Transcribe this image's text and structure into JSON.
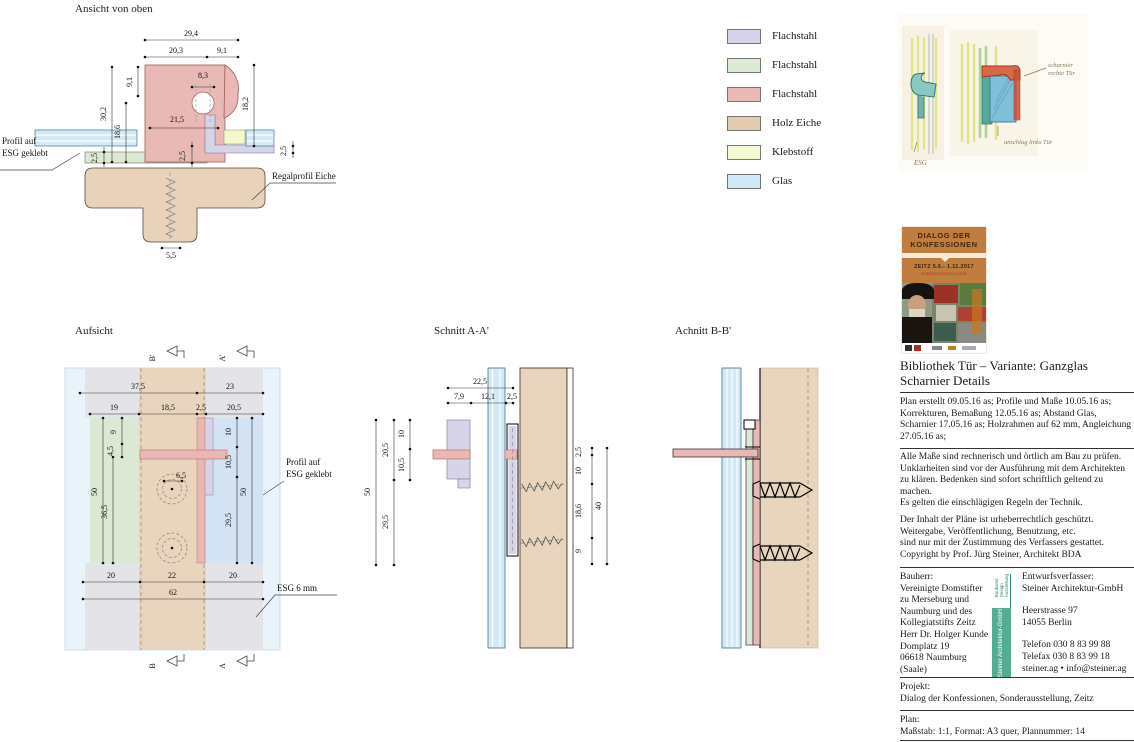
{
  "legend": {
    "items": [
      {
        "label": "Flachstahl",
        "color": "#d6d4e9"
      },
      {
        "label": "Flachstahl",
        "color": "#dcead6"
      },
      {
        "label": "Flachstahl",
        "color": "#e9b9b5"
      },
      {
        "label": "Holz Eiche",
        "color": "#e3c9ae"
      },
      {
        "label": "Klebstoff",
        "color": "#f5f9d2"
      },
      {
        "label": "Glas",
        "color": "#cfe9f7"
      }
    ]
  },
  "views": {
    "ansicht": {
      "title": "Ansicht von oben",
      "dims": {
        "w_total": "29,4",
        "w_left": "20,3",
        "w_right": "9,1",
        "hole": "8,3",
        "right_v": "18,2",
        "left_v1": "30,2",
        "left_v2": "18,6",
        "left_v3": "9,1",
        "mid": "21,5",
        "small_l1": "2,5",
        "small_l2": "2,5",
        "small_r": "2,5",
        "bottom": "5,5"
      },
      "callout_profil_1": "Profil auf",
      "callout_profil_2": "ESG geklebt",
      "callout_regal": "Regalprofil Eiche"
    },
    "aufsicht": {
      "title": "Aufsicht",
      "dims": {
        "t1": "37,5",
        "t2": "23",
        "t3": "19",
        "t4": "18,5",
        "t5": "2,5",
        "t6": "20,5",
        "v_l1": "50",
        "v_l2": "36,5",
        "v_l3": "9",
        "v_l4": "4,5",
        "v_r1": "10",
        "v_r2": "10,5",
        "v_r3": "50",
        "v_r4": "29,5",
        "hole": "6,5",
        "b1": "20",
        "b2": "22",
        "b3": "20",
        "b4": "62"
      },
      "markers": {
        "top_b": "B'",
        "top_a": "A'",
        "bot_b": "B",
        "bot_a": "A"
      },
      "callout_profil_1": "Profil auf",
      "callout_profil_2": "ESG geklebt",
      "callout_esg": "ESG 6 mm"
    },
    "schnitt_a": {
      "title": "Schnitt A-A'",
      "dims": {
        "t1": "22,5",
        "t2": "7,9",
        "t3": "12,1",
        "t4": "2,5",
        "l1": "50",
        "l2": "20,5",
        "l3": "10,5",
        "l4": "10",
        "l5": "29,5",
        "r1": "2,5",
        "r2": "10",
        "r3": "18,6",
        "r4": "9",
        "r5": "40"
      }
    },
    "schnitt_b": {
      "title": "Achnitt B-B'"
    }
  },
  "sketch": {
    "note_hinge_1": "scharnier",
    "note_hinge_2": "rechte Tür",
    "note_stop": "anschlag links Tür",
    "note_esg": "ESG"
  },
  "poster": {
    "line1": "DIALOG DER",
    "line2": "KONFESSIONEN",
    "date": "ZEITZ 5.6.- 1.11.2017",
    "sub": "SONDERAUSSTELLUNG"
  },
  "titleblock": {
    "title_line1": "Bibliothek Tür – Variante: Ganzglas",
    "title_line2": "Scharnier Details",
    "revisions": "Plan erstellt 09.05.16 as; Profile und Maße 10.05.16 as;\nKorrekturen, Bemaßung 12.05.16 as; Abstand Glas,\nScharnier 17.05.16 as; Holzrahmen auf 62 mm, Angleichung\n27.05.16 as;",
    "note_check": "Alle Maße sind rechnerisch und örtlich am Bau zu prüfen.\nUnklarheiten sind vor der Ausführung mit dem Architekten\nzu klären. Bedenken sind sofort schriftlich geltend zu\nmachen.\nEs gelten die einschlägigen Regeln der Technik.",
    "note_copyright": "Der Inhalt der Pläne ist urheberrechtlich geschützt.\nWeitergabe, Veröffentlichung, Benutzung, etc.\nsind nur mit der Zustimmung des Verfassers gestattet.\nCopyright by Prof. Jürg Steiner, Architekt BDA",
    "bauherr_label": "Bauherr:",
    "bauherr_lines": "Vereinigte Domstifter\nzu Merseburg und\nNaumburg und des\nKollegiatstifts Zeitz\nHerr Dr. Holger Kunde\nDomplatz 19\n06618 Naumburg\n(Saale)",
    "badge_small": "Baukunst\nDesign\nAusstellung",
    "badge_main": "Steiner Architektur-GmbH",
    "entwurf_label": "Entwurfsverfasser:",
    "entwurf_name": "Steiner Architektur-GmbH",
    "entwurf_address": "Heerstrasse 97\n14055 Berlin",
    "entwurf_contact": "Telefon 030 8 83 99 88\nTelefax 030 8 83 99 18\nsteiner.ag • info@steiner.ag",
    "projekt_label": "Projekt:",
    "projekt_value": "Dialog der Konfessionen, Sonderausstellung, Zeitz",
    "plan_label": "Plan:",
    "plan_value": "Maßstab: 1:1,  Format: A3 quer, Plannummer: 14"
  }
}
